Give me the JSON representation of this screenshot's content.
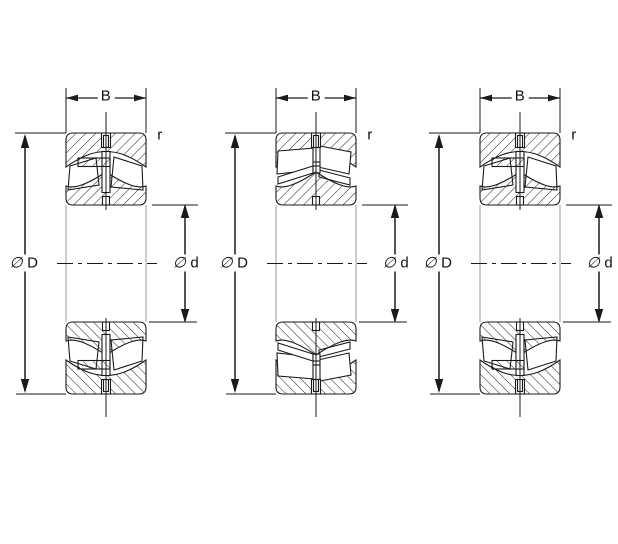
{
  "bearings": [
    {
      "name": "left-bearing-diagram",
      "width_label": "B",
      "corner_radius_label": "r",
      "outer_diameter_symbol": "∅",
      "outer_diameter_letter": "D",
      "bore_diameter_symbol": "∅",
      "bore_diameter_letter": "d"
    },
    {
      "name": "middle-bearing-diagram",
      "width_label": "B",
      "corner_radius_label": "r",
      "outer_diameter_symbol": "∅",
      "outer_diameter_letter": "D",
      "bore_diameter_symbol": "∅",
      "bore_diameter_letter": "d"
    },
    {
      "name": "right-bearing-diagram",
      "width_label": "B",
      "corner_radius_label": "r",
      "outer_diameter_symbol": "∅",
      "outer_diameter_letter": "D",
      "bore_diameter_symbol": "∅",
      "bore_diameter_letter": "d"
    }
  ]
}
